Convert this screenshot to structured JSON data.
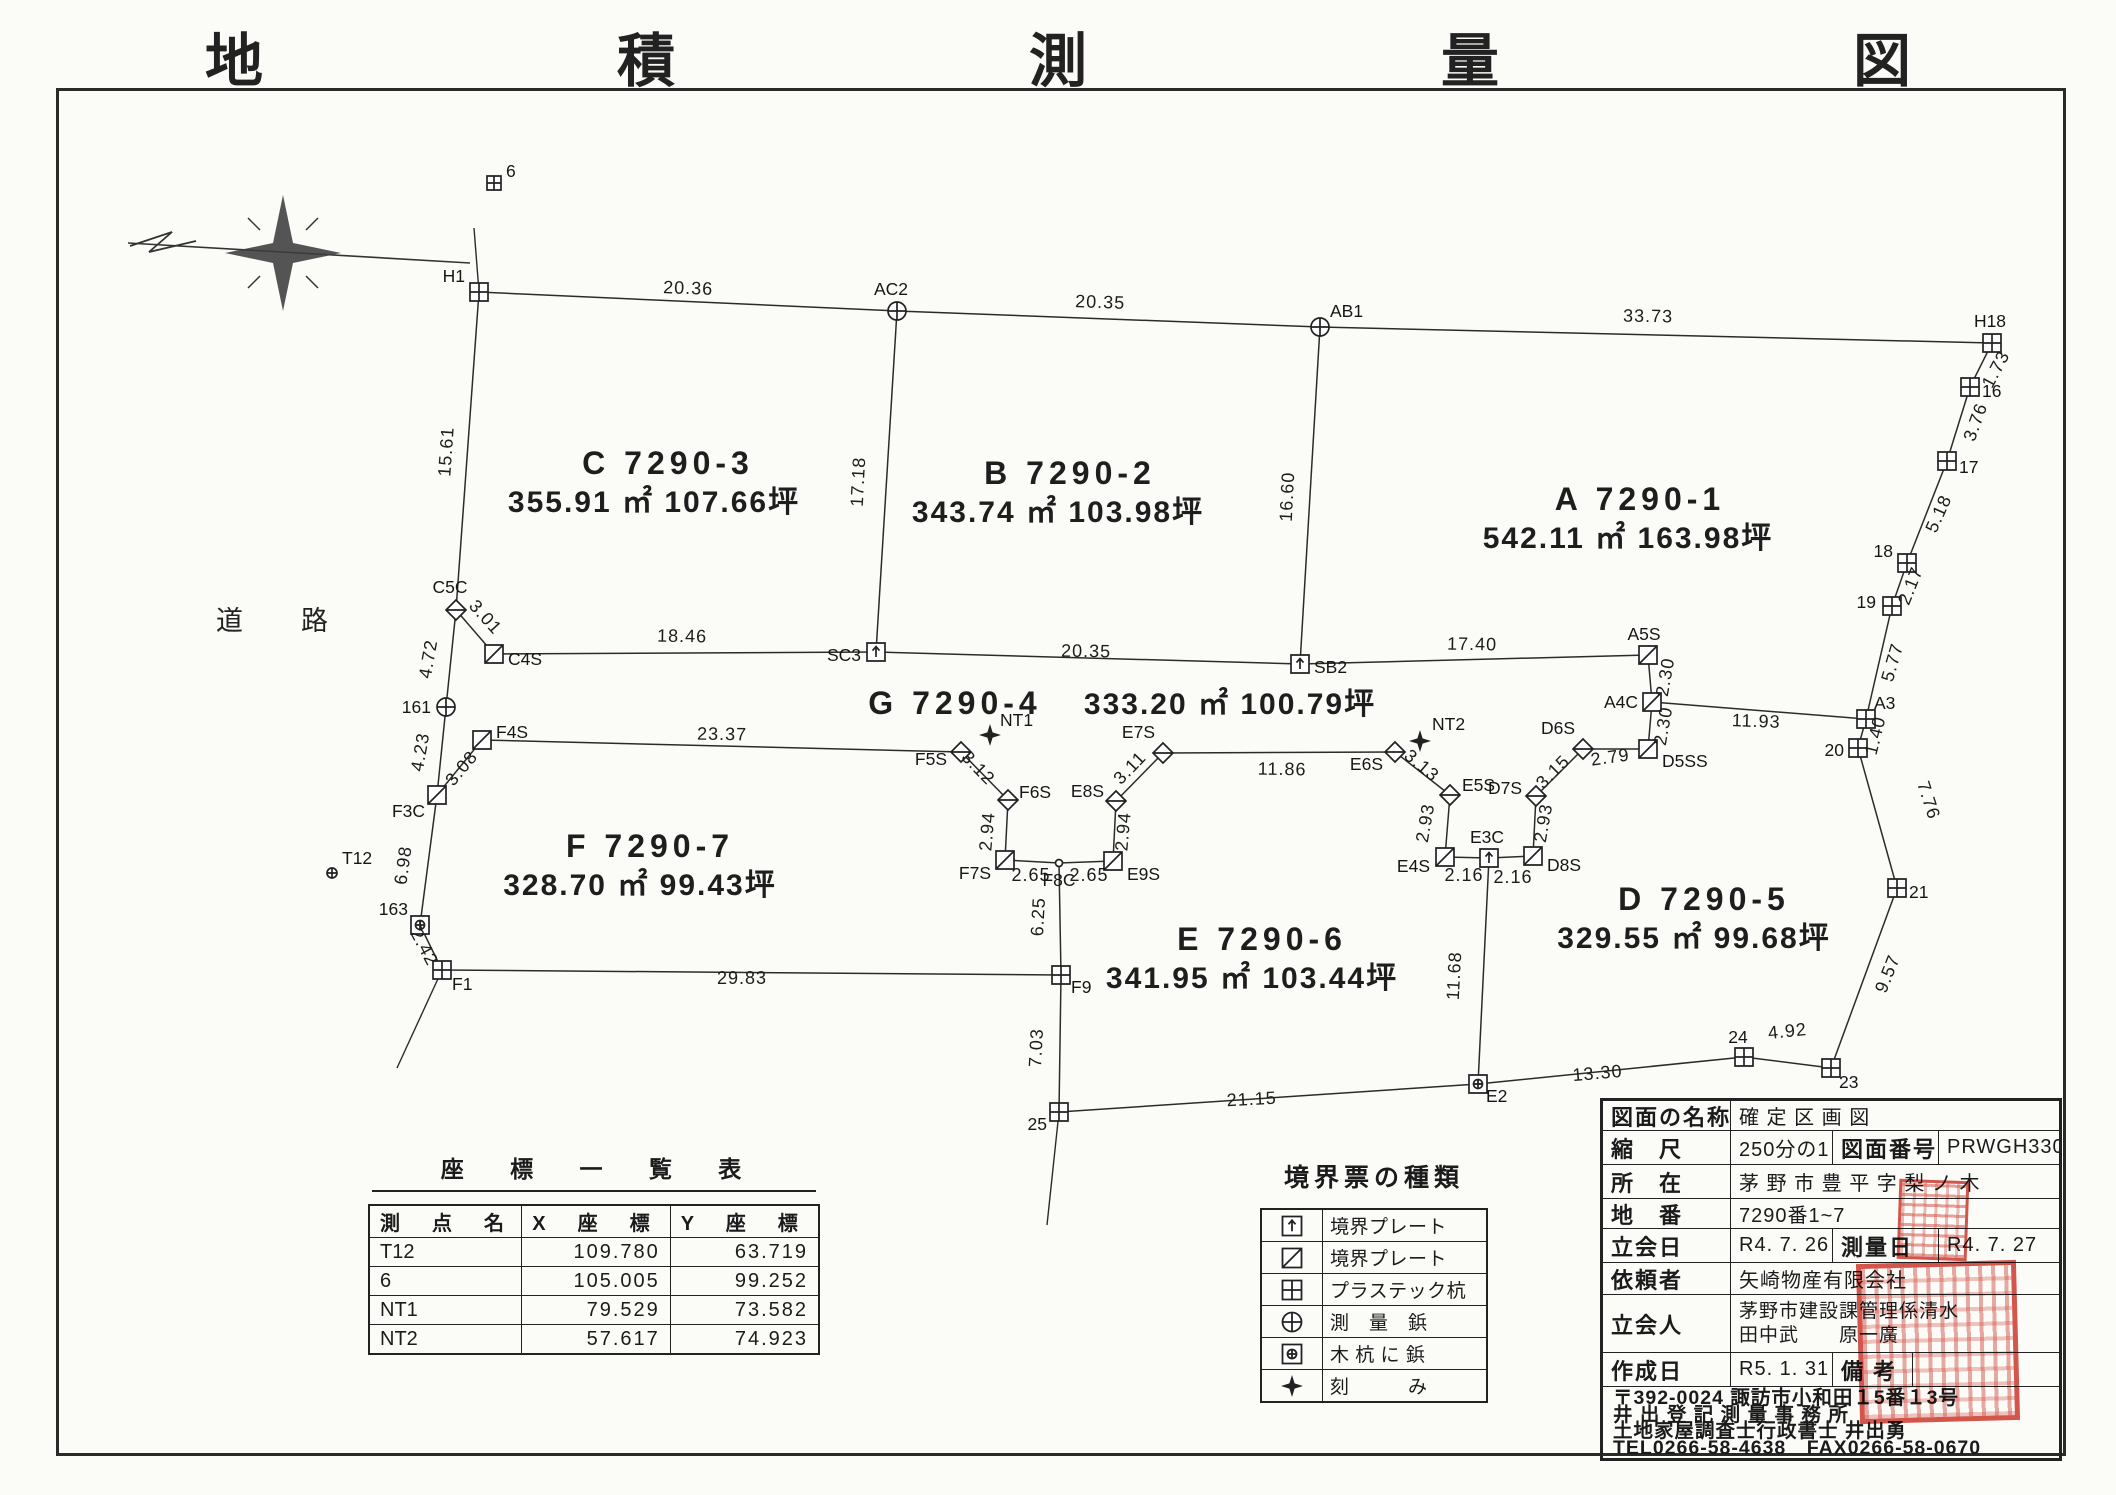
{
  "title": "地　積　測　量　図",
  "road_label": "道路",
  "icons": [
    "north-compass-icon"
  ],
  "seal_color": "#cf3226",
  "map": {
    "points": [
      {
        "n": "6",
        "x": 494,
        "y": 183,
        "m": "sq_cross",
        "s": 7,
        "dx": 12,
        "dy": -6,
        "a": "start"
      },
      {
        "n": "H1",
        "x": 479,
        "y": 292,
        "m": "sq_cross",
        "dx": -14,
        "dy": -10,
        "a": "end"
      },
      {
        "n": "AC2",
        "x": 897,
        "y": 311,
        "m": "circ_cross",
        "dx": -6,
        "dy": -16,
        "a": "middle"
      },
      {
        "n": "AB1",
        "x": 1320,
        "y": 327,
        "m": "circ_cross",
        "dx": 10,
        "dy": -10,
        "a": "start"
      },
      {
        "n": "H18",
        "x": 1992,
        "y": 343,
        "m": "sq_cross",
        "dx": -2,
        "dy": -16,
        "a": "middle"
      },
      {
        "n": "16",
        "x": 1970,
        "y": 387,
        "m": "sq_cross",
        "dx": 12,
        "dy": 10,
        "a": "start"
      },
      {
        "n": "17",
        "x": 1947,
        "y": 461,
        "m": "sq_cross",
        "dx": 12,
        "dy": 12,
        "a": "start"
      },
      {
        "n": "18",
        "x": 1907,
        "y": 563,
        "m": "sq_cross",
        "dx": -14,
        "dy": -6,
        "a": "end"
      },
      {
        "n": "19",
        "x": 1892,
        "y": 606,
        "m": "sq_cross",
        "dx": -16,
        "dy": 2,
        "a": "end"
      },
      {
        "n": "A3",
        "x": 1866,
        "y": 719,
        "m": "sq_cross",
        "dx": 8,
        "dy": -10,
        "a": "start"
      },
      {
        "n": "20",
        "x": 1858,
        "y": 748,
        "m": "sq_cross",
        "dx": -14,
        "dy": 8,
        "a": "end"
      },
      {
        "n": "21",
        "x": 1897,
        "y": 888,
        "m": "sq_cross",
        "dx": 12,
        "dy": 10,
        "a": "start"
      },
      {
        "n": "23",
        "x": 1831,
        "y": 1068,
        "m": "sq_cross",
        "dx": 8,
        "dy": 20,
        "a": "start"
      },
      {
        "n": "24",
        "x": 1744,
        "y": 1057,
        "m": "sq_cross",
        "dx": -6,
        "dy": -14,
        "a": "middle"
      },
      {
        "n": "E2",
        "x": 1478,
        "y": 1084,
        "m": "sq_circ",
        "dx": 8,
        "dy": 18,
        "a": "start"
      },
      {
        "n": "25",
        "x": 1059,
        "y": 1112,
        "m": "sq_cross",
        "dx": -12,
        "dy": 18,
        "a": "end"
      },
      {
        "n": "C5C",
        "x": 456,
        "y": 610,
        "m": "diamond",
        "dx": -6,
        "dy": -17,
        "a": "middle"
      },
      {
        "n": "C4S",
        "x": 494,
        "y": 654,
        "m": "sq_diag",
        "dx": 14,
        "dy": 11,
        "a": "start"
      },
      {
        "n": "161",
        "x": 446,
        "y": 707,
        "m": "circ_cross",
        "dx": -15,
        "dy": 6,
        "a": "end"
      },
      {
        "n": "F3C",
        "x": 437,
        "y": 795,
        "m": "sq_diag",
        "dx": -12,
        "dy": 22,
        "a": "end"
      },
      {
        "n": "F4S",
        "x": 482,
        "y": 740,
        "m": "sq_diag",
        "dx": 14,
        "dy": -2,
        "a": "start"
      },
      {
        "n": "163",
        "x": 420,
        "y": 925,
        "m": "sq_circ",
        "dx": -12,
        "dy": -10,
        "a": "end"
      },
      {
        "n": "F1",
        "x": 442,
        "y": 970,
        "m": "sq_cross",
        "dx": 10,
        "dy": 20,
        "a": "start"
      },
      {
        "n": "T12",
        "x": 332,
        "y": 873,
        "m": "circ_cross",
        "s": 5,
        "dx": 10,
        "dy": -9,
        "a": "start"
      },
      {
        "n": "SC3",
        "x": 876,
        "y": 652,
        "m": "sq_arrow",
        "dx": -15,
        "dy": 9,
        "a": "end"
      },
      {
        "n": "SB2",
        "x": 1300,
        "y": 664,
        "m": "sq_arrow",
        "dx": 14,
        "dy": 9,
        "a": "start"
      },
      {
        "n": "A5S",
        "x": 1648,
        "y": 655,
        "m": "sq_diag",
        "dx": -4,
        "dy": -15,
        "a": "middle"
      },
      {
        "n": "A4C",
        "x": 1652,
        "y": 702,
        "m": "sq_diag",
        "dx": -14,
        "dy": 6,
        "a": "end"
      },
      {
        "n": "D5SS",
        "x": 1648,
        "y": 749,
        "m": "sq_diag",
        "dx": 14,
        "dy": 18,
        "a": "start"
      },
      {
        "n": "NT1",
        "x": 990,
        "y": 735,
        "m": "star4",
        "dx": 10,
        "dy": -9,
        "a": "start"
      },
      {
        "n": "F5S",
        "x": 961,
        "y": 752,
        "m": "diamond",
        "dx": -14,
        "dy": 13,
        "a": "end"
      },
      {
        "n": "F6S",
        "x": 1008,
        "y": 800,
        "m": "diamond",
        "dx": 11,
        "dy": -2,
        "a": "start"
      },
      {
        "n": "F7S",
        "x": 1005,
        "y": 860,
        "m": "sq_diag",
        "dx": -14,
        "dy": 19,
        "a": "end"
      },
      {
        "n": "F8C",
        "x": 1059,
        "y": 863,
        "m": "dot",
        "dx": 0,
        "dy": 23,
        "a": "middle"
      },
      {
        "n": "E9S",
        "x": 1113,
        "y": 861,
        "m": "sq_diag",
        "dx": 14,
        "dy": 19,
        "a": "start"
      },
      {
        "n": "E8S",
        "x": 1116,
        "y": 801,
        "m": "diamond",
        "dx": -12,
        "dy": -4,
        "a": "end"
      },
      {
        "n": "E7S",
        "x": 1163,
        "y": 753,
        "m": "diamond",
        "dx": -8,
        "dy": -15,
        "a": "end"
      },
      {
        "n": "E6S",
        "x": 1395,
        "y": 752,
        "m": "diamond",
        "dx": -12,
        "dy": 18,
        "a": "end"
      },
      {
        "n": "NT2",
        "x": 1420,
        "y": 741,
        "m": "star4",
        "dx": 12,
        "dy": -11,
        "a": "start"
      },
      {
        "n": "E5S",
        "x": 1450,
        "y": 795,
        "m": "diamond",
        "dx": 12,
        "dy": -4,
        "a": "start"
      },
      {
        "n": "E4S",
        "x": 1445,
        "y": 857,
        "m": "sq_diag",
        "dx": -15,
        "dy": 15,
        "a": "end"
      },
      {
        "n": "E3C",
        "x": 1489,
        "y": 858,
        "m": "sq_arrow",
        "dx": -2,
        "dy": -15,
        "a": "middle"
      },
      {
        "n": "D8S",
        "x": 1533,
        "y": 856,
        "m": "sq_diag",
        "dx": 14,
        "dy": 15,
        "a": "start"
      },
      {
        "n": "D7S",
        "x": 1536,
        "y": 796,
        "m": "diamond",
        "dx": -14,
        "dy": -2,
        "a": "end"
      },
      {
        "n": "D6S",
        "x": 1583,
        "y": 749,
        "m": "diamond",
        "dx": -8,
        "dy": -15,
        "a": "end"
      },
      {
        "n": "F9",
        "x": 1061,
        "y": 975,
        "m": "sq_cross",
        "dx": 10,
        "dy": 18,
        "a": "start"
      }
    ],
    "segments": [
      [
        "H1",
        "AC2"
      ],
      [
        "AC2",
        "AB1"
      ],
      [
        "AB1",
        "H18"
      ],
      [
        "H18",
        "16"
      ],
      [
        "16",
        "17"
      ],
      [
        "17",
        "18"
      ],
      [
        "18",
        "19"
      ],
      [
        "19",
        "A3"
      ],
      [
        "A3",
        "20"
      ],
      [
        "20",
        "21"
      ],
      [
        "21",
        "23"
      ],
      [
        "23",
        "24"
      ],
      [
        "24",
        "E2"
      ],
      [
        "E2",
        "25"
      ],
      [
        "H1",
        "C5C"
      ],
      [
        "C5C",
        "161"
      ],
      [
        "161",
        "F3C"
      ],
      [
        "F3C",
        "163"
      ],
      [
        "163",
        "F1"
      ],
      [
        "C5C",
        "C4S"
      ],
      [
        "C4S",
        "SC3"
      ],
      [
        "SC3",
        "SB2"
      ],
      [
        "SB2",
        "A5S"
      ],
      [
        "AC2",
        "SC3"
      ],
      [
        "AB1",
        "SB2"
      ],
      [
        "A5S",
        "A4C"
      ],
      [
        "A4C",
        "D5SS"
      ],
      [
        "A4C",
        "A3"
      ],
      [
        "F3C",
        "F4S"
      ],
      [
        "F4S",
        "F5S"
      ],
      [
        "F5S",
        "F6S"
      ],
      [
        "F6S",
        "F7S"
      ],
      [
        "F7S",
        "F8C"
      ],
      [
        "F8C",
        "E9S"
      ],
      [
        "E9S",
        "E8S"
      ],
      [
        "E8S",
        "E7S"
      ],
      [
        "E7S",
        "E6S"
      ],
      [
        "E6S",
        "E5S"
      ],
      [
        "E5S",
        "E4S"
      ],
      [
        "E4S",
        "E3C"
      ],
      [
        "E3C",
        "D8S"
      ],
      [
        "D8S",
        "D7S"
      ],
      [
        "D7S",
        "D6S"
      ],
      [
        "D6S",
        "D5SS"
      ],
      [
        "F1",
        "F9"
      ],
      [
        "F8C",
        "F9"
      ],
      [
        "F9",
        "25"
      ],
      [
        "E3C",
        "E2"
      ]
    ],
    "trails": [
      [
        1059,
        1112,
        1047,
        1225
      ],
      [
        442,
        970,
        397,
        1068
      ],
      [
        479,
        292,
        474,
        228
      ]
    ],
    "dims": [
      {
        "t": "20.36",
        "x": 688,
        "y": 294,
        "r": 2
      },
      {
        "t": "20.35",
        "x": 1100,
        "y": 308,
        "r": 2
      },
      {
        "t": "33.73",
        "x": 1648,
        "y": 322,
        "r": 1
      },
      {
        "t": "15.61",
        "x": 452,
        "y": 452,
        "r": -86
      },
      {
        "t": "17.18",
        "x": 864,
        "y": 482,
        "r": -87
      },
      {
        "t": "16.60",
        "x": 1293,
        "y": 497,
        "r": -87
      },
      {
        "t": "1.73",
        "x": 2001,
        "y": 372,
        "r": -62
      },
      {
        "t": "3.76",
        "x": 1981,
        "y": 424,
        "r": -70
      },
      {
        "t": "5.18",
        "x": 1944,
        "y": 516,
        "r": -66
      },
      {
        "t": "2.17",
        "x": 1916,
        "y": 588,
        "r": -68
      },
      {
        "t": "5.77",
        "x": 1898,
        "y": 664,
        "r": -74
      },
      {
        "t": "1.40",
        "x": 1881,
        "y": 737,
        "r": -76
      },
      {
        "t": "7.76",
        "x": 1923,
        "y": 802,
        "r": 72
      },
      {
        "t": "9.57",
        "x": 1893,
        "y": 976,
        "r": -68
      },
      {
        "t": "4.92",
        "x": 1788,
        "y": 1037,
        "r": -6
      },
      {
        "t": "13.30",
        "x": 1598,
        "y": 1079,
        "r": -5
      },
      {
        "t": "21.15",
        "x": 1252,
        "y": 1105,
        "r": -3
      },
      {
        "t": "29.83",
        "x": 742,
        "y": 984,
        "r": 0
      },
      {
        "t": "7.03",
        "x": 1042,
        "y": 1048,
        "r": -87
      },
      {
        "t": "6.25",
        "x": 1044,
        "y": 917,
        "r": -87
      },
      {
        "t": "11.68",
        "x": 1460,
        "y": 976,
        "r": -87
      },
      {
        "t": "2.16",
        "x": 1464,
        "y": 881,
        "r": 0
      },
      {
        "t": "2.16",
        "x": 1513,
        "y": 883,
        "r": 0
      },
      {
        "t": "2.93",
        "x": 1431,
        "y": 824,
        "r": -80
      },
      {
        "t": "2.93",
        "x": 1549,
        "y": 824,
        "r": -80
      },
      {
        "t": "3.13",
        "x": 1418,
        "y": 770,
        "r": 40
      },
      {
        "t": "3.15",
        "x": 1557,
        "y": 776,
        "r": -45
      },
      {
        "t": "2.79",
        "x": 1611,
        "y": 763,
        "r": -8
      },
      {
        "t": "2.30",
        "x": 1671,
        "y": 678,
        "r": -80
      },
      {
        "t": "2.30",
        "x": 1669,
        "y": 727,
        "r": -80
      },
      {
        "t": "11.93",
        "x": 1756,
        "y": 727,
        "r": 2
      },
      {
        "t": "17.40",
        "x": 1472,
        "y": 650,
        "r": 1
      },
      {
        "t": "20.35",
        "x": 1086,
        "y": 657,
        "r": 1
      },
      {
        "t": "18.46",
        "x": 682,
        "y": 642,
        "r": 1
      },
      {
        "t": "3.01",
        "x": 481,
        "y": 621,
        "r": 48
      },
      {
        "t": "4.72",
        "x": 434,
        "y": 660,
        "r": -80
      },
      {
        "t": "4.23",
        "x": 426,
        "y": 753,
        "r": -80
      },
      {
        "t": "3.08",
        "x": 466,
        "y": 772,
        "r": -50
      },
      {
        "t": "6.98",
        "x": 409,
        "y": 866,
        "r": -82
      },
      {
        "t": "2.42",
        "x": 419,
        "y": 950,
        "r": 62
      },
      {
        "t": "23.37",
        "x": 722,
        "y": 740,
        "r": 1
      },
      {
        "t": "3.12",
        "x": 974,
        "y": 772,
        "r": 46
      },
      {
        "t": "2.94",
        "x": 993,
        "y": 832,
        "r": -85
      },
      {
        "t": "2.94",
        "x": 1129,
        "y": 832,
        "r": -85
      },
      {
        "t": "2.65",
        "x": 1031,
        "y": 881,
        "r": 0
      },
      {
        "t": "2.65",
        "x": 1089,
        "y": 881,
        "r": 0
      },
      {
        "t": "3.11",
        "x": 1134,
        "y": 772,
        "r": -46
      },
      {
        "t": "11.86",
        "x": 1282,
        "y": 775,
        "r": 1
      }
    ],
    "parcel_labels": [
      {
        "t": "C 7290-3",
        "x": 668,
        "y": 474,
        "cls": "lot"
      },
      {
        "t": "355.91 ㎡ 107.66坪",
        "x": 654,
        "y": 512,
        "cls": "area"
      },
      {
        "t": "B 7290-2",
        "x": 1070,
        "y": 484,
        "cls": "lot"
      },
      {
        "t": "343.74 ㎡ 103.98坪",
        "x": 1058,
        "y": 522,
        "cls": "area"
      },
      {
        "t": "A 7290-1",
        "x": 1640,
        "y": 510,
        "cls": "lot"
      },
      {
        "t": "542.11 ㎡ 163.98坪",
        "x": 1628,
        "y": 548,
        "cls": "area"
      },
      {
        "t": "G 7290-4",
        "x": 955,
        "y": 714,
        "cls": "lot"
      },
      {
        "t": "333.20 ㎡ 100.79坪",
        "x": 1230,
        "y": 714,
        "cls": "area"
      },
      {
        "t": "F 7290-7",
        "x": 650,
        "y": 857,
        "cls": "lot"
      },
      {
        "t": "328.70 ㎡  99.43坪",
        "x": 640,
        "y": 895,
        "cls": "area"
      },
      {
        "t": "E 7290-6",
        "x": 1262,
        "y": 950,
        "cls": "lot"
      },
      {
        "t": "341.95 ㎡ 103.44坪",
        "x": 1252,
        "y": 988,
        "cls": "area"
      },
      {
        "t": "D 7290-5",
        "x": 1704,
        "y": 910,
        "cls": "lot"
      },
      {
        "t": "329.55 ㎡  99.68坪",
        "x": 1694,
        "y": 948,
        "cls": "area"
      }
    ]
  },
  "coord_table": {
    "title": "座 標 一 覧 表",
    "headers": [
      "測　点　名",
      "X　座　標",
      "Y　座　標"
    ],
    "rows": [
      [
        "T12",
        "109.780",
        "63.719"
      ],
      [
        "6",
        "105.005",
        "99.252"
      ],
      [
        "NT1",
        "79.529",
        "73.582"
      ],
      [
        "NT2",
        "57.617",
        "74.923"
      ]
    ]
  },
  "legend": {
    "title": "境界票の種類",
    "items": [
      {
        "marker": "sq_arrow",
        "icon": "boundary-plate-arrow-icon",
        "label": "境界プレート"
      },
      {
        "marker": "sq_diag",
        "icon": "boundary-plate-diagonal-icon",
        "label": "境界プレート"
      },
      {
        "marker": "sq_cross",
        "icon": "plastic-stake-icon",
        "label": "プラステック杭"
      },
      {
        "marker": "circ_cross",
        "icon": "survey-nail-icon",
        "label": "測　量　鋲"
      },
      {
        "marker": "sq_circ",
        "icon": "nail-in-wood-stake-icon",
        "label": "木 杭 に 鋲"
      },
      {
        "marker": "star4",
        "icon": "chisel-mark-icon",
        "label": "刻　　　み"
      }
    ]
  },
  "info_table": {
    "rows": [
      {
        "h": 30,
        "cells": [
          {
            "t": "図面の名称",
            "w": 128,
            "cls": "lbl"
          },
          {
            "t": "確 定 区 画 図",
            "cls": "val"
          }
        ]
      },
      {
        "h": 34,
        "cells": [
          {
            "t": "縮　尺",
            "w": 128,
            "cls": "lbl"
          },
          {
            "t": "250分の1",
            "w": 102,
            "cls": "val"
          },
          {
            "t": "図面番号",
            "w": 106,
            "cls": "lbl"
          },
          {
            "t": "PRWGH330",
            "cls": "val"
          }
        ]
      },
      {
        "h": 34,
        "cells": [
          {
            "t": "所　在",
            "w": 128,
            "cls": "lbl"
          },
          {
            "t": "茅 野 市 豊 平 字 梨 ノ 木",
            "cls": "val"
          }
        ]
      },
      {
        "h": 30,
        "cells": [
          {
            "t": "地　番",
            "w": 128,
            "cls": "lbl"
          },
          {
            "t": "7290番1~7",
            "cls": "val"
          }
        ]
      },
      {
        "h": 34,
        "cells": [
          {
            "t": "立会日",
            "w": 128,
            "cls": "lbl"
          },
          {
            "t": "R4. 7. 26",
            "w": 102,
            "cls": "val"
          },
          {
            "t": "測量日",
            "w": 106,
            "cls": "lbl"
          },
          {
            "t": "R4. 7. 27",
            "cls": "val"
          }
        ]
      },
      {
        "h": 32,
        "cells": [
          {
            "t": "依頼者",
            "w": 128,
            "cls": "lbl"
          },
          {
            "t": "矢崎物産有限会社",
            "cls": "val"
          }
        ]
      },
      {
        "h": 58,
        "cells": [
          {
            "t": "立会人",
            "w": 128,
            "cls": "lbl"
          },
          {
            "t": "茅野市建設課管理係清水\n田中武　　原一廣",
            "cls": "val multiline"
          }
        ]
      },
      {
        "h": 34,
        "cells": [
          {
            "t": "作成日",
            "w": 128,
            "cls": "lbl"
          },
          {
            "t": "R5. 1. 31",
            "w": 102,
            "cls": "val"
          },
          {
            "t": "備 考",
            "w": 80,
            "cls": "lbl"
          },
          {
            "t": "",
            "cls": "val"
          }
        ]
      }
    ],
    "footer_lines": [
      "〒392-0024 諏訪市小和田１5番１3号",
      "井 出 登 記 測 量 事 務 所",
      "土地家屋調査士行政書士 井出勇",
      "TEL0266-58-4638　FAX0266-58-0670"
    ]
  }
}
